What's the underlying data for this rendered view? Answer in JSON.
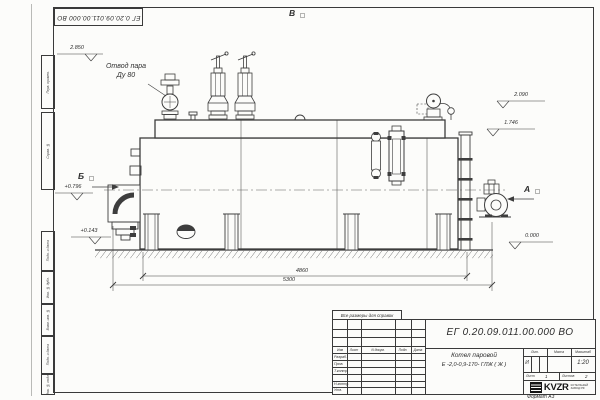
{
  "frame": {
    "designation_rotated": "ЕГ 0.20.09.011.00.000  ВО",
    "left_labels": [
      "Перв. примен.",
      "Справ. №",
      "Подп. и дата",
      "Инв. № дубл.",
      "Взам. инв. №",
      "Подп. и дата",
      "Инв. № подл."
    ]
  },
  "drawing": {
    "steam_label_line1": "Отвод пара",
    "steam_label_line2": "Ду 80",
    "view_top": "В",
    "view_left": "Б",
    "view_right": "А",
    "elev_2850": "2.850",
    "elev_2090": "2.090",
    "elev_1746": "1.746",
    "elev_0796": "+0.796",
    "elev_0143": "+0.143",
    "elev_0000": "0.000",
    "dim_inner": "4860",
    "dim_outer": "5300"
  },
  "title_block": {
    "note": "Все размеры для справок",
    "designation": "ЕГ 0.20.09.011.00.000  ВО",
    "name_line1": "Котел паровой",
    "name_line2": "Е -2,0-0,9-170- ГЛЖ ( Ж )",
    "col_izm": "Изм",
    "col_list": "Лист",
    "col_ndoc": "N докум.",
    "col_podp": "Подп.",
    "col_data": "Дата",
    "row_razrab": "Разраб.",
    "row_prov": "Пров.",
    "row_tkontr": "Т.контр.",
    "row_nkontr": "Н.контр.",
    "row_utv": "Утв.",
    "lit_label": "Лит.",
    "lit_value": "И",
    "mass_label": "Масса",
    "scale_label": "Масштаб",
    "scale_value": "1:20",
    "sheet_label": "Лист",
    "sheet_value": "1",
    "sheets_label": "Листов",
    "sheets_value": "2",
    "logo_text": "KVZR",
    "logo_sub1": "КОТЕЛЬНЫЙ",
    "logo_sub2": "ЗАВОД РФ",
    "format_note": "Формат А3"
  }
}
